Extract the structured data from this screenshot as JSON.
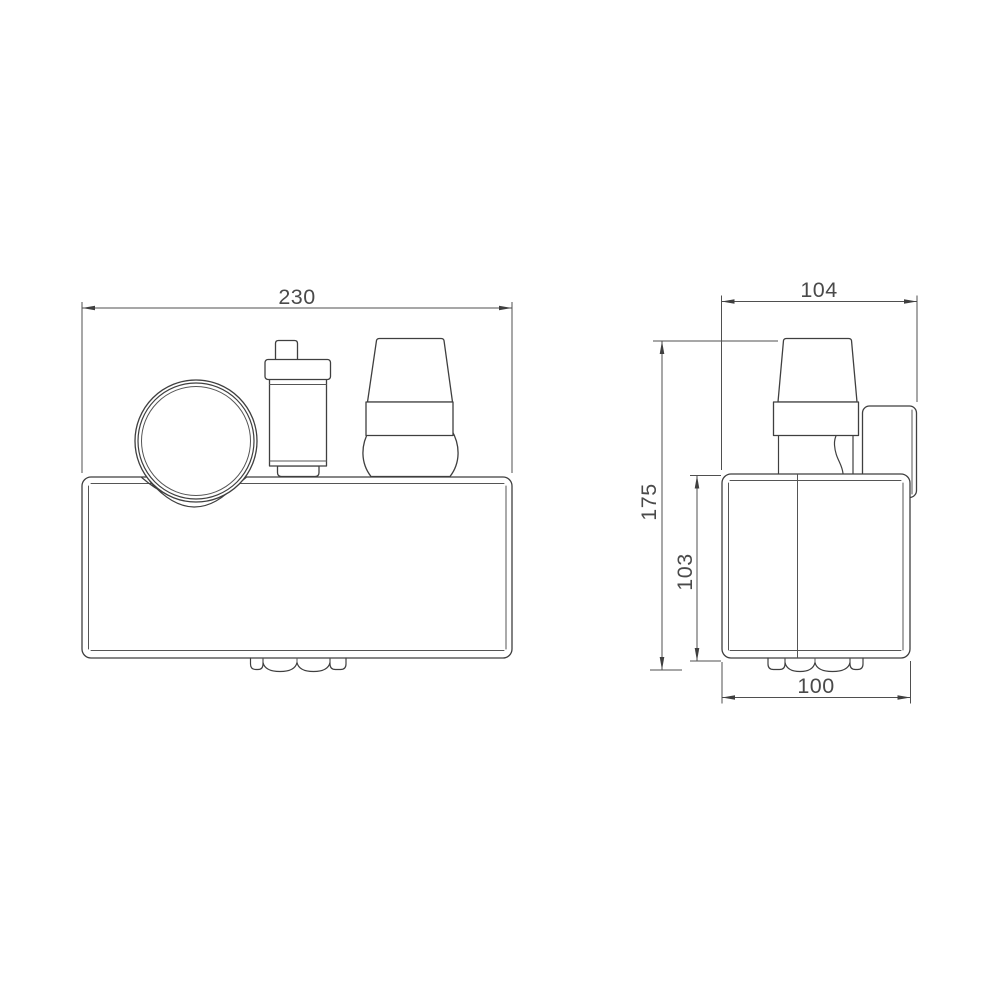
{
  "colors": {
    "background": "#ffffff",
    "line": "#3f3f3f",
    "dimension_text": "#4a4a4a"
  },
  "dimensions": {
    "front_overall_width": "230",
    "side_overall_width": "104",
    "side_overall_height": "175",
    "side_body_height": "103",
    "side_body_width": "100"
  }
}
